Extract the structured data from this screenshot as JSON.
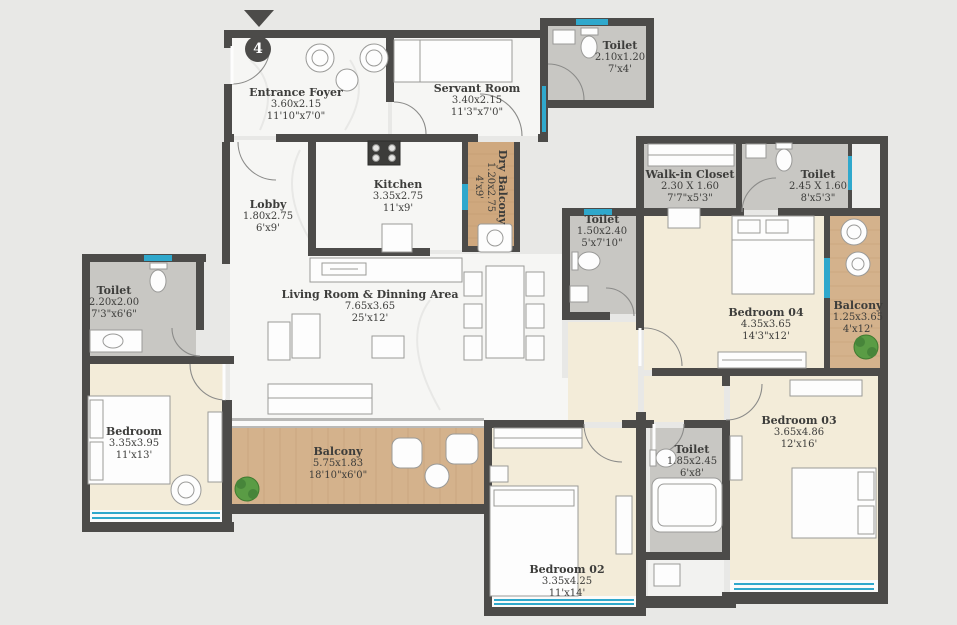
{
  "unit": {
    "number": "4"
  },
  "colors": {
    "wall": "#4c4b49",
    "marble_floor": "#f6f6f4",
    "toilet_floor": "#c8c7c3",
    "bedroom_floor": "#f3ecd9",
    "wood_floor": "#d4b28c",
    "window": "#2fa8cc",
    "background": "#e8e8e6"
  },
  "rooms": [
    {
      "id": "entrance-foyer",
      "name": "Entrance Foyer",
      "dim_m": "3.60x2.15",
      "dim_ft": "11'10\"x7'0\""
    },
    {
      "id": "servant-room",
      "name": "Servant Room",
      "dim_m": "3.40x2.15",
      "dim_ft": "11'3\"x7'0\""
    },
    {
      "id": "toilet-top",
      "name": "Toilet",
      "dim_m": "2.10x1.20",
      "dim_ft": "7'x4'"
    },
    {
      "id": "lobby",
      "name": "Lobby",
      "dim_m": "1.80x2.75",
      "dim_ft": "6'x9'"
    },
    {
      "id": "kitchen",
      "name": "Kitchen",
      "dim_m": "3.35x2.75",
      "dim_ft": "11'x9'"
    },
    {
      "id": "dry-balcony",
      "name": "Dry Balcony",
      "dim_m": "1.20x2.75",
      "dim_ft": "4'x9'"
    },
    {
      "id": "toilet-mid",
      "name": "Toilet",
      "dim_m": "1.50x2.40",
      "dim_ft": "5'x7'10\""
    },
    {
      "id": "walk-in-closet",
      "name": "Walk-in Closet",
      "dim_m": "2.30 X 1.60",
      "dim_ft": "7'7\"x5'3\""
    },
    {
      "id": "toilet-bed04",
      "name": "Toilet",
      "dim_m": "2.45 X 1.60",
      "dim_ft": "8'x5'3\""
    },
    {
      "id": "bedroom-04",
      "name": "Bedroom 04",
      "dim_m": "4.35x3.65",
      "dim_ft": "14'3\"x12'"
    },
    {
      "id": "balcony-right",
      "name": "Balcony",
      "dim_m": "1.25x3.65",
      "dim_ft": "4'x12'"
    },
    {
      "id": "toilet-left",
      "name": "Toilet",
      "dim_m": "2.20x2.00",
      "dim_ft": "7'3\"x6'6\""
    },
    {
      "id": "living-dining",
      "name": "Living Room & Dinning Area",
      "dim_m": "7.65x3.65",
      "dim_ft": "25'x12'"
    },
    {
      "id": "bedroom-left",
      "name": "Bedroom",
      "dim_m": "3.35x3.95",
      "dim_ft": "11'x13'"
    },
    {
      "id": "balcony-main",
      "name": "Balcony",
      "dim_m": "5.75x1.83",
      "dim_ft": "18'10\"x6'0\""
    },
    {
      "id": "bedroom-02",
      "name": "Bedroom 02",
      "dim_m": "3.35x4.25",
      "dim_ft": "11'x14'"
    },
    {
      "id": "toilet-bed03",
      "name": "Toilet",
      "dim_m": "1.85x2.45",
      "dim_ft": "6'x8'"
    },
    {
      "id": "bedroom-03",
      "name": "Bedroom 03",
      "dim_m": "3.65x4.86",
      "dim_ft": "12'x16'"
    }
  ]
}
